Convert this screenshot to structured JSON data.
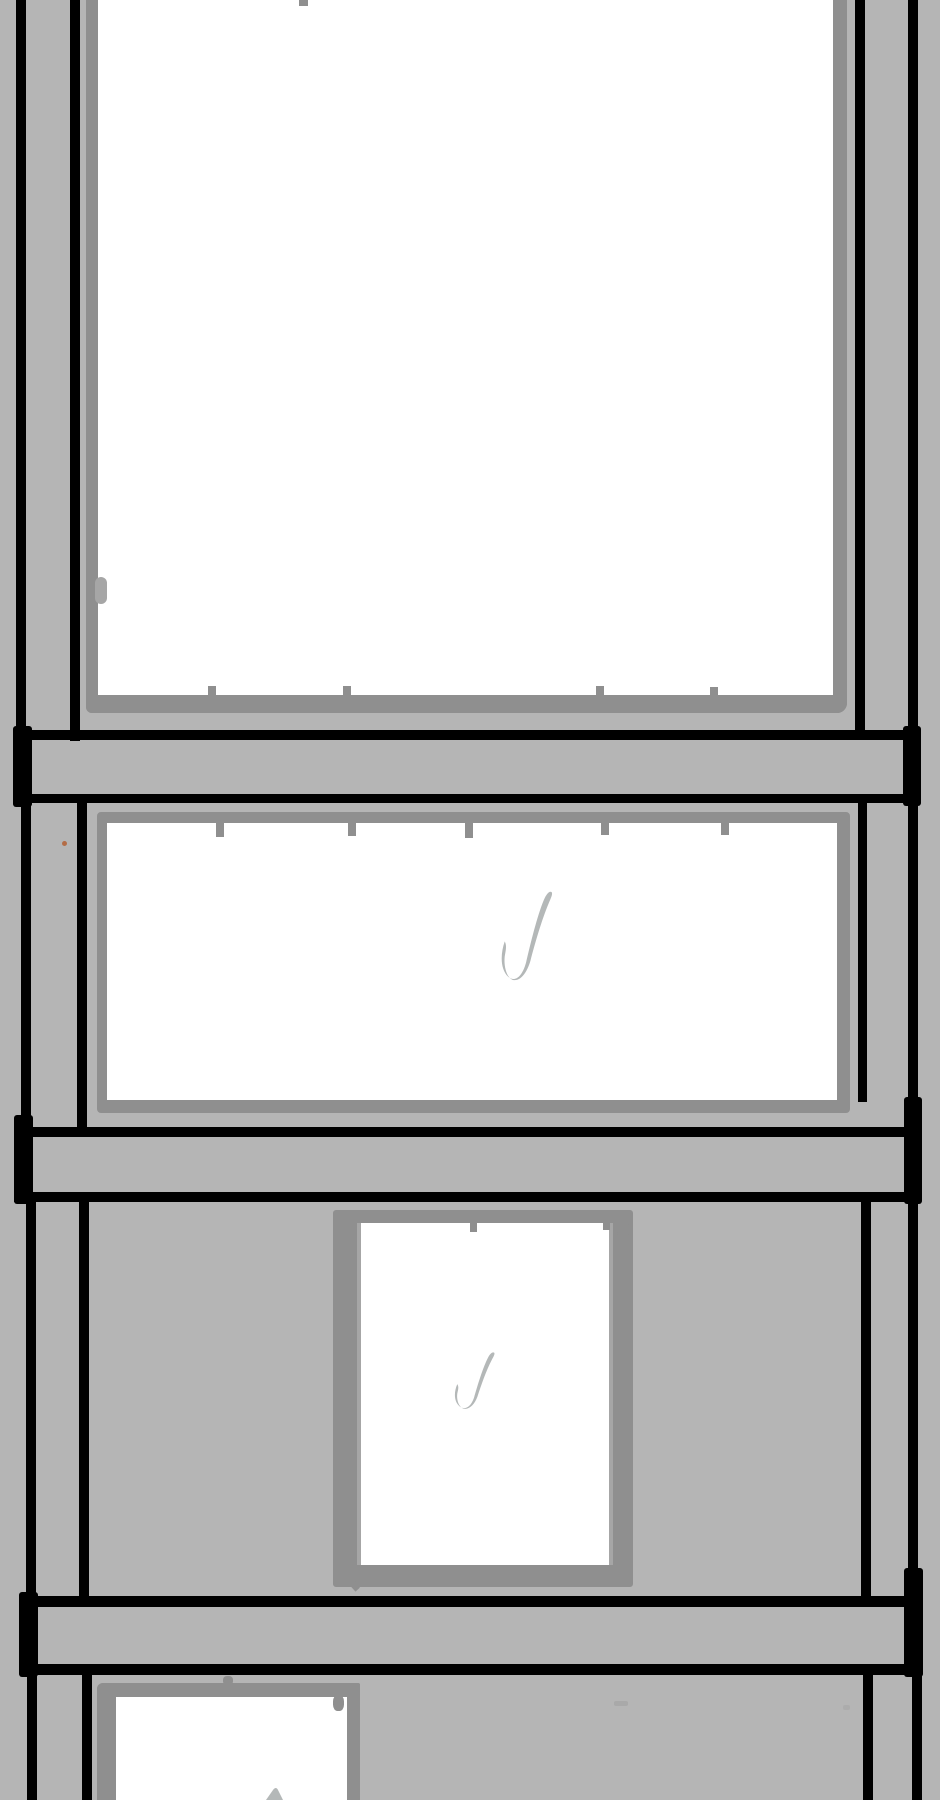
{
  "colors": {
    "background": "#b5b5b5",
    "frame": "#8f8f8f",
    "frame_light": "#a6a6a6",
    "line": "#000000",
    "glass": "#ffffff",
    "check": "#b4b8b8",
    "speck": "#9f9f9f",
    "accent_dot": "#b35a2a"
  },
  "icons": {
    "check": "brush-check-mark"
  },
  "sketch": {
    "panels": [
      {
        "id": "panel-1",
        "checked": false
      },
      {
        "id": "panel-2",
        "checked": true
      },
      {
        "id": "panel-3",
        "checked": true
      },
      {
        "id": "panel-4",
        "checked": true
      }
    ]
  }
}
